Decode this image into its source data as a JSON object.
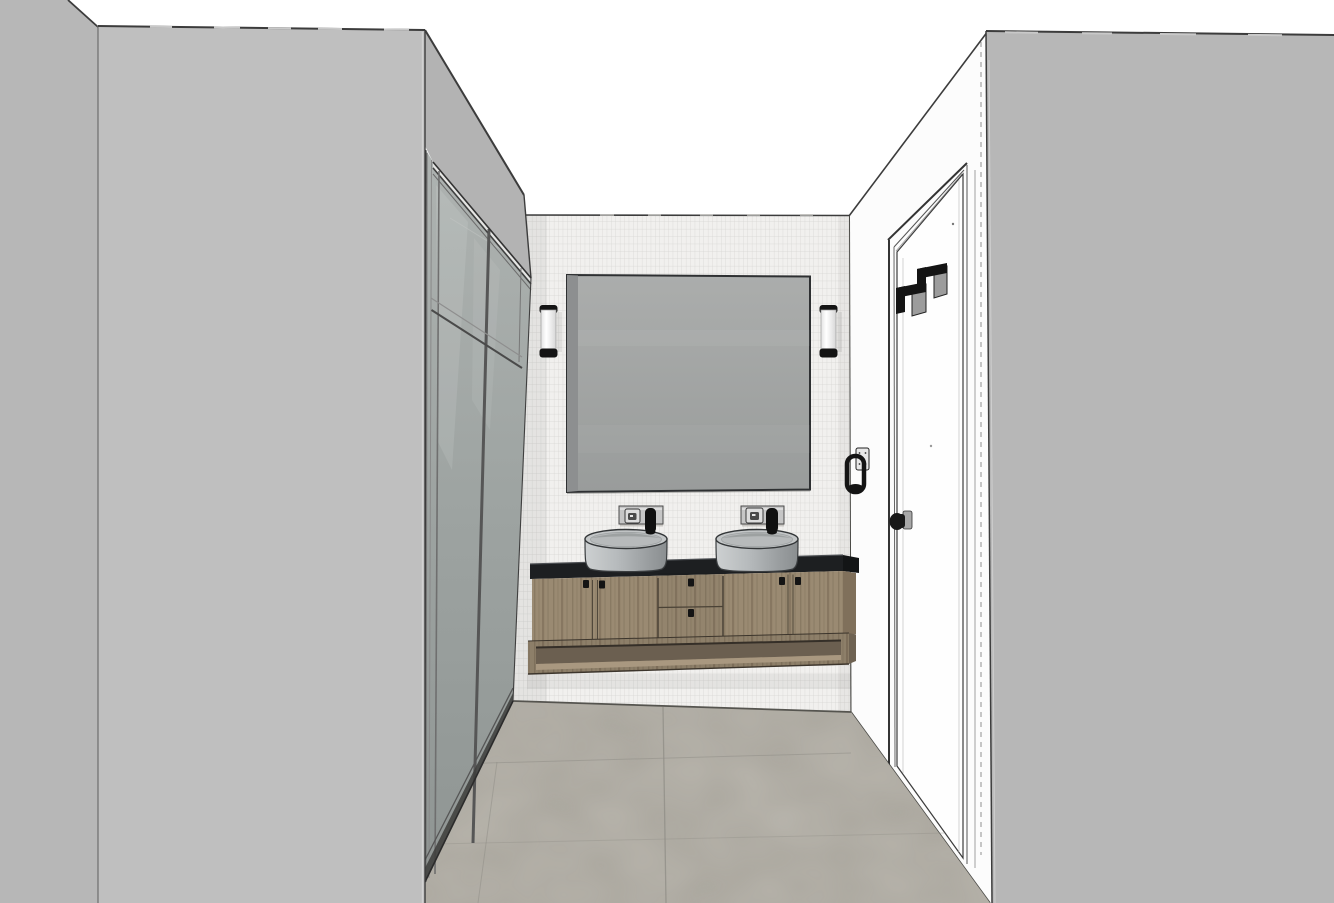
{
  "app": {
    "name": "3d-interior-render",
    "view": "bathroom vanity wall, perspective view, sketch-style render"
  },
  "scene": {
    "colors": {
      "background": "#ffffff",
      "left_wall": "#bfbfbf",
      "left_wall_return": "#b7b7b7",
      "right_wall": "#b7b7b7",
      "bulkhead": "#b3b3b3",
      "bulkhead_highlight": "#e6e6e4",
      "tile": "#f1f0ee",
      "tile_grout": "#d6d5d2",
      "door_wall": "#fcfcfc",
      "door_leaf": "#fefefe",
      "mirror": "#a3a6a5",
      "mirror_edge": "#8d8f90",
      "wardrobe_glass_top": "#aeb3b1",
      "wardrobe_glass_bottom": "#8f9593",
      "countertop": "#1d1f21",
      "countertop_side": "#131516",
      "wood": "#9a8a72",
      "wood_dark": "#7c6d58",
      "shelf_recess": "#6b5f50",
      "sink_light": "#cdd0d1",
      "sink_dark": "#8a8e90",
      "floor": "#a9a59c",
      "floor_grout": "#8f8d86",
      "fixture_black": "#141414",
      "fixture_plate": "#c6c6c6",
      "sconce_body": "#fbfbfb",
      "outline": "#3c3c3c",
      "hidden_line": "#9a9a9a"
    },
    "objects": {
      "left_wall": "left wall",
      "wardrobe": "glass wardrobe front",
      "bulkhead": "wardrobe bulkhead",
      "tile_wall": "mosaic tile wall",
      "mirror": "rectangular mirror",
      "sconce_left": "wall sconce",
      "sconce_right": "wall sconce",
      "faucet_left": "wall mixer tap",
      "faucet_right": "wall mixer tap",
      "sink_left": "round vessel basin",
      "sink_right": "round vessel basin",
      "countertop": "black countertop",
      "vanity": "floating timber vanity",
      "open_shelf": "open shelf niche",
      "floor": "grey tile floor",
      "door": "white door",
      "door_handle": "door handle",
      "robe_hooks": "double robe hooks",
      "wall_holder": "towel ring holder",
      "right_wall": "right wall"
    }
  }
}
